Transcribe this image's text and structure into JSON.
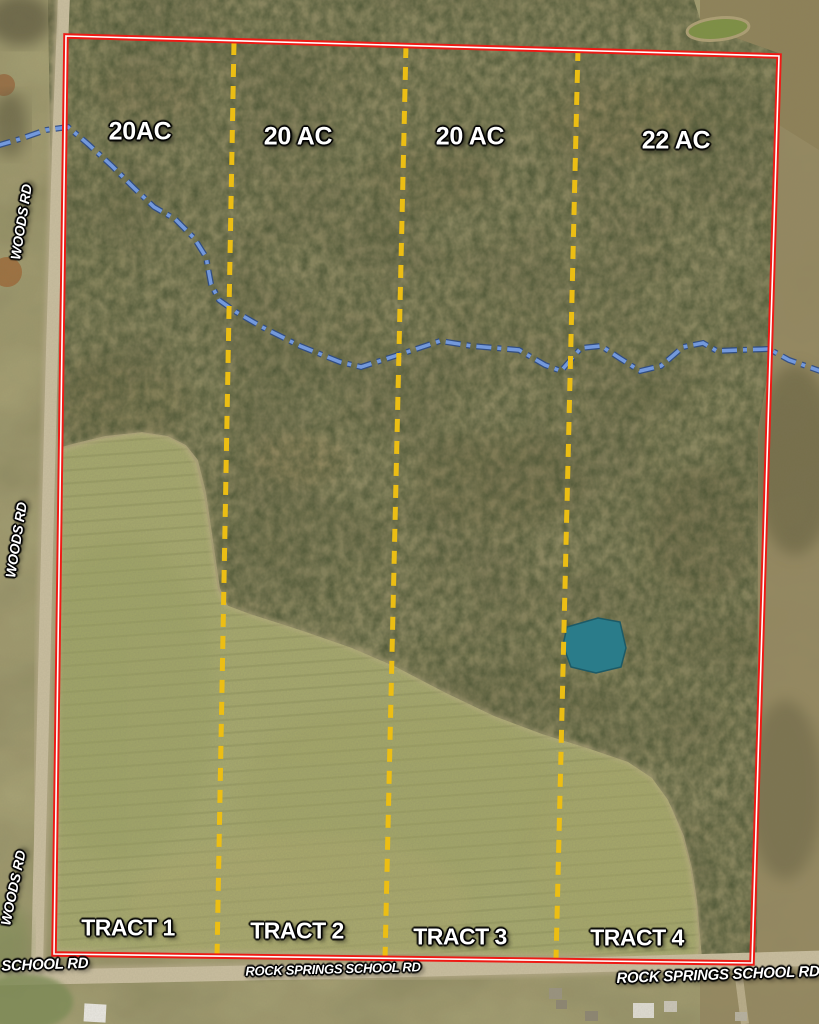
{
  "map": {
    "type": "aerial-land-tract-survey",
    "acreage_labels": [
      "20AC",
      "20 AC",
      "20 AC",
      "22 AC"
    ],
    "tract_labels": [
      "TRACT 1",
      "TRACT 2",
      "TRACT 3",
      "TRACT 4"
    ],
    "road_labels": {
      "woods_rd": "WOODS RD",
      "school_rd_partial": "S SCHOOL RD",
      "rock_springs_school_rd": "ROCK SPRINGS SCHOOL RD"
    },
    "colors": {
      "boundary": "#ee1a15",
      "boundary_core": "#ffffff",
      "divider": "#ecbe14",
      "creek": "#7399dc",
      "pond": "#2a7c8a",
      "field": "#a6a96d"
    }
  }
}
